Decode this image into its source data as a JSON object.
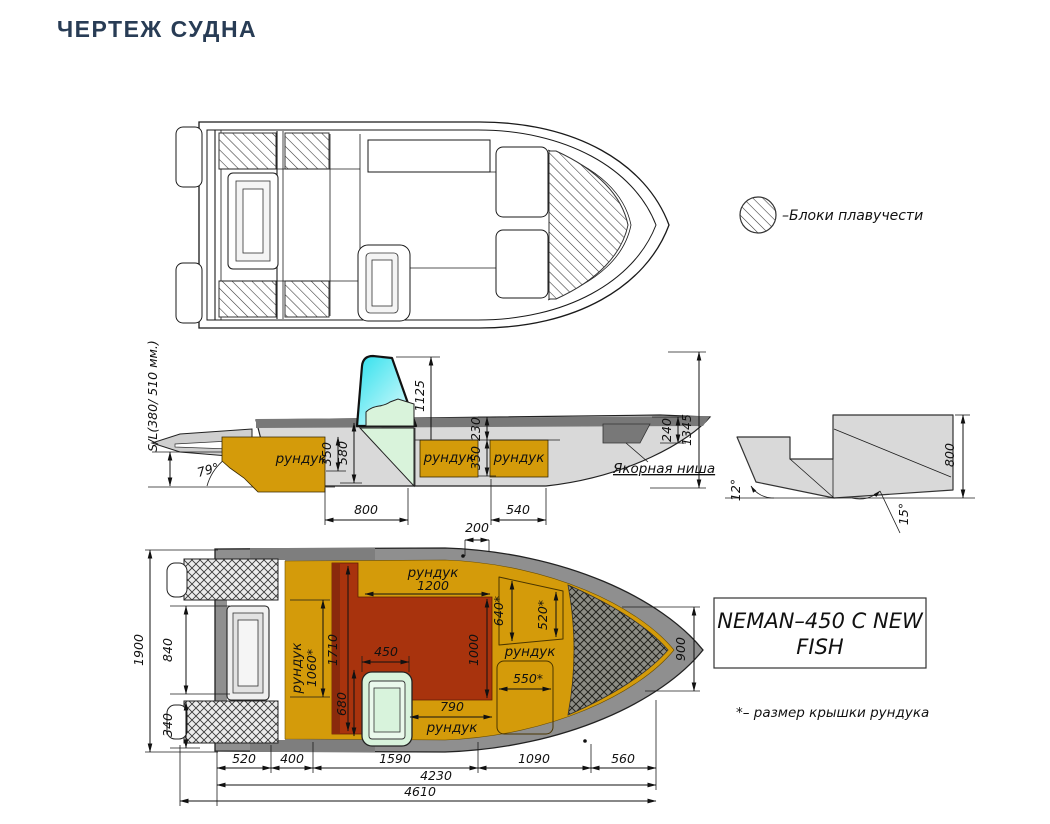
{
  "title": "ЧЕРТЕЖ СУДНА",
  "legend": {
    "label": "–Блоки плавучести"
  },
  "model_box": {
    "line1": "NEMAN–450 C NEW",
    "line2": "FISH"
  },
  "footnote": "*– размер крышки рундука",
  "side_view": {
    "transom_label": "S/L(380/ 510 мм.)",
    "angle_stern": "79°",
    "d1125": "1125",
    "d580": "580",
    "d350a": "350",
    "d230": "230",
    "d350b": "350",
    "d240": "240",
    "d1345": "1345",
    "d800": "800",
    "d540": "540",
    "runduk_aft": "рундук",
    "runduk_mid": "рундук",
    "runduk_fwd": "рундук",
    "anchor_niche": "Якорная ниша"
  },
  "transom_view": {
    "angle_left": "12°",
    "angle_right": "15°",
    "d800": "800"
  },
  "plan_view": {
    "d200": "200",
    "d1900": "1900",
    "d840": "840",
    "d340": "340",
    "d900": "900",
    "b520": "520",
    "b400": "400",
    "b1590": "1590",
    "b1090": "1090",
    "b560": "560",
    "d4230": "4230",
    "d4610": "4610",
    "runduk_top": "рундук",
    "d1200": "1200",
    "runduk_left": "рундук",
    "d1060": "1060*",
    "d1710": "1710",
    "d450": "450",
    "d680": "680",
    "d1000": "1000",
    "d790": "790",
    "runduk_bottom": "рундук",
    "d640": "640*",
    "d520s": "520*",
    "runduk_bow": "рундук",
    "d550": "550*"
  },
  "colors": {
    "title": "#283C55",
    "deck_orange": "#D49B0A",
    "floor_red": "#A8330D",
    "floor_red_dark": "#8A2A0C",
    "seat_green": "#D8F3DC",
    "console_green": "#D9F3DB",
    "hull_gray": "#D9D9D9",
    "band_gray": "#8F8F8F",
    "dark_gray": "#787878",
    "windshield_cyan": "#2FE0ED",
    "line": "#1A1A1A"
  }
}
